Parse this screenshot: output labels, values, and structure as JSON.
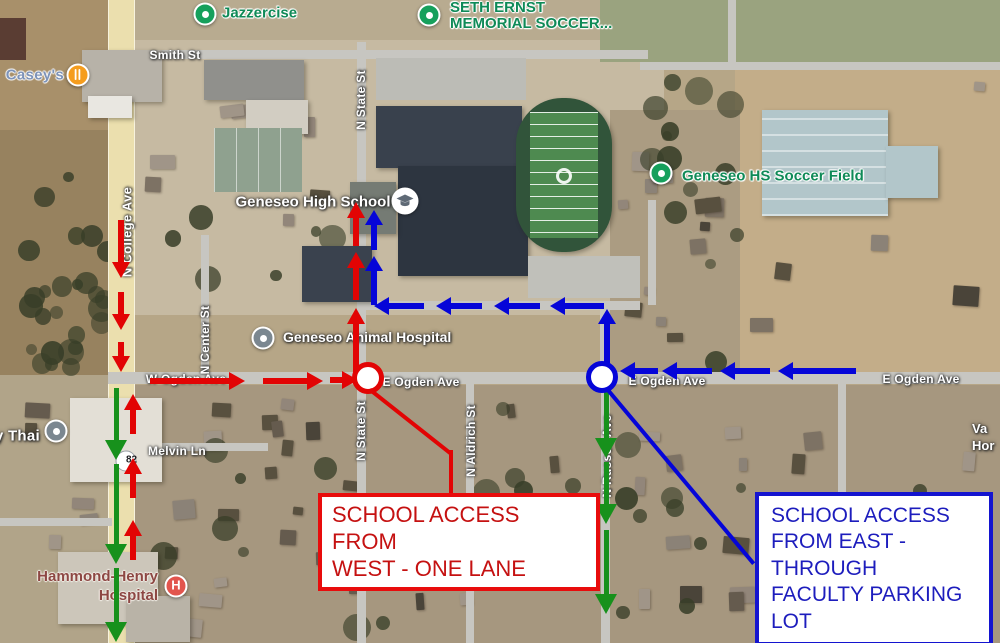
{
  "pois": {
    "caseys": {
      "label": "Casey's"
    },
    "jazzercise": {
      "label": "Jazzercise"
    },
    "seth_ernst": {
      "label": "SETH ERNST\nMEMORIAL SOCCER..."
    },
    "geneseo_high_school": {
      "label": "Geneseo High School"
    },
    "geneseo_hs_soccer_field": {
      "label": "Geneseo HS Soccer Field"
    },
    "geneseo_animal_hospital": {
      "label": "Geneseo Animal Hospital"
    },
    "y_thai": {
      "label": "y Thai"
    },
    "hammond_henry": {
      "label": "Hammond-Henry\nHospital",
      "pin_letter": "H"
    },
    "edge_partial": {
      "label": "Va\nHor"
    }
  },
  "streets": {
    "smith": "Smith St",
    "n_state_top": "N State St",
    "n_state_south": "N State St",
    "n_college": "N College Ave",
    "n_center": "N Center St",
    "w_ogden": "W Ogden Ave",
    "e_ogden_west": "E Ogden Ave",
    "e_ogden_mid": "E Ogden Ave",
    "e_ogden_east": "E Ogden Ave",
    "n_aldrich": "N Aldrich St",
    "n_russell": "N Russell Ave",
    "melvin": "Melvin Ln",
    "route_shield": "82"
  },
  "callouts": {
    "west": {
      "text": "SCHOOL ACCESS FROM\nWEST - ONE LANE",
      "text_color": "#c51111",
      "border_color": "#e80c0c"
    },
    "east": {
      "text": "SCHOOL ACCESS\nFROM EAST -\nTHROUGH\nFACULTY PARKING\nLOT",
      "text_color": "#1d1dbd",
      "border_color": "#1414cf"
    }
  },
  "routes": {
    "inbound_west_color": "#e20404",
    "inbound_east_color": "#0505d8",
    "outbound_color": "#17911c"
  }
}
